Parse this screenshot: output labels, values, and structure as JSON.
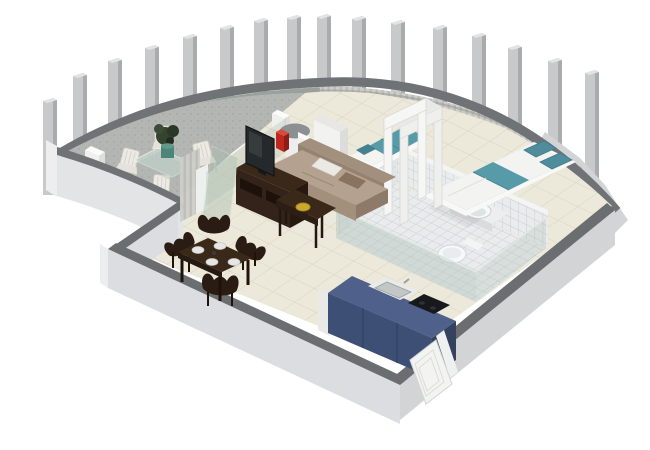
{
  "scene": {
    "type": "isometric-3d-apartment-floor-plan-render",
    "background": "#ffffff",
    "pillar_count": 16,
    "rooms": [
      {
        "id": "terrace",
        "label": "curved terrace",
        "items": [
          "glass-outdoor-table",
          "white-outdoor-chairs",
          "potted-plant",
          "storage-box"
        ]
      },
      {
        "id": "living-dining",
        "label": "living and dining area",
        "items": [
          "espresso-dining-table",
          "four-sculpted-chairs",
          "four-place-settings",
          "taupe-sofa",
          "white-pillow",
          "brown-pillow",
          "coffee-table",
          "yellow-bowl",
          "tv-stand",
          "flat-screen-tv",
          "red-vase",
          "glass-partition",
          "open-glass-door"
        ]
      },
      {
        "id": "bedroom",
        "label": "bedroom",
        "items": [
          "double-bed-teal-runner",
          "two-teal-pillows",
          "single-bed-teal-duvet",
          "curtain-wall",
          "white-wardrobe",
          "white-doorway-frames",
          "nightstand-cube",
          "round-column"
        ]
      },
      {
        "id": "bathroom",
        "label": "bathroom",
        "items": [
          "tiled-walls",
          "tiled-floor",
          "countertop-basin",
          "toilet",
          "glass-shower-screen"
        ]
      },
      {
        "id": "kitchen",
        "label": "kitchenette",
        "items": [
          "blue-cabinet-block",
          "inset-sink",
          "black-cooktop"
        ]
      },
      {
        "id": "entry",
        "label": "entrance",
        "items": [
          "white-paneled-front-door",
          "door-frame"
        ]
      }
    ],
    "architecture": [
      "curved-colonnade-of-pillars",
      "curved-parapet-band",
      "terrace-parapet-wall",
      "cutaway-exterior-walls"
    ]
  },
  "colors": {
    "background": "#ffffff",
    "wall_cap": "#6b6e71",
    "wall_face": "#dcdde0",
    "parapet_face": "#e3e4e6",
    "outer_wall": "#d3d4d6",
    "pillar_front": "#c7c9cb",
    "pillar_side": "#a9abad",
    "band_top": "#6f7376",
    "terrace_band": "#9aa09b",
    "terrace_floor": "#b4b6b4",
    "interior_floor": "#ece8da",
    "curtain_light": "#cecec9",
    "curtain_dark": "#bcbcb8",
    "teal": "#579aa8",
    "teal_deep": "#44808f",
    "sofa": "#b4a190",
    "sofa_shade": "#95826f",
    "wood": "#3a2819",
    "wood_dark": "#241710",
    "kitchen_top": "#4f618a",
    "kitchen_front": "#3e4f75",
    "kitchen_side": "#344260",
    "cooktop": "#17191d",
    "glass": "#a9beaf",
    "tile": "#e9ebec",
    "grout": "#c2c7ca",
    "fixture": "#f7f8f9",
    "vase_red": "#c0281f",
    "bowl_yellow": "#c9a92e",
    "door_white": "#f3f3f2"
  }
}
